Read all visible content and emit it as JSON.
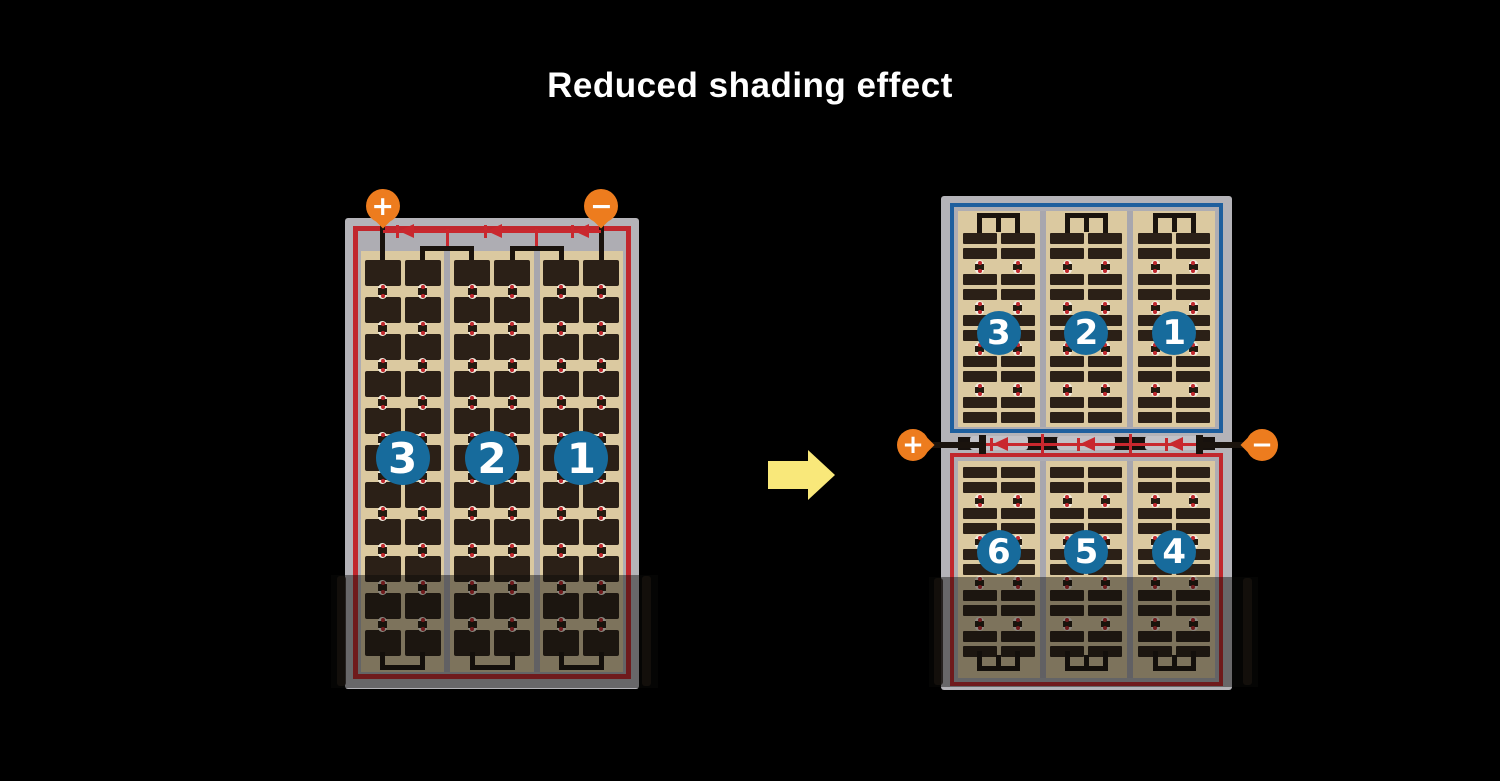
{
  "title": "Reduced shading effect",
  "colors": {
    "background": "#000000",
    "title_text": "#ffffff",
    "frame_gray": "#b4b3b8",
    "inner_gray": "#aeadb3",
    "cell_mat": "#dbc9a0",
    "cell_dark": "#2b2017",
    "divider_gray": "#a8a7ae",
    "border_red": "#c1272d",
    "border_blue": "#1e5f9e",
    "wire_black": "#1a130d",
    "wire_red": "#c9282e",
    "terminal_orange": "#ed7c1e",
    "badge_blue": "#176b9c",
    "arrow_yellow": "#f9e87a",
    "connector_white": "#f2ecdf",
    "connector_dot_red": "#c1272d",
    "junction_dark": "#17110d",
    "diode_housing_gray": "#c2c1c6"
  },
  "left_panel": {
    "description": "full-cell module",
    "terminal_positive": "+",
    "terminal_negative": "−",
    "string_numbers": [
      "3",
      "2",
      "1"
    ],
    "bypass_diodes": 3,
    "cell_rows": 11,
    "cell_columns": 6,
    "shaded_bottom": true
  },
  "right_panel": {
    "description": "half-cut split module",
    "terminal_positive": "+",
    "terminal_negative": "−",
    "top_half": {
      "string_numbers": [
        "3",
        "2",
        "1"
      ],
      "border": "blue"
    },
    "bottom_half": {
      "string_numbers": [
        "6",
        "5",
        "4"
      ],
      "border": "red"
    },
    "bypass_diodes": 3,
    "shaded_bottom": true
  },
  "arrow": {
    "direction": "right"
  }
}
